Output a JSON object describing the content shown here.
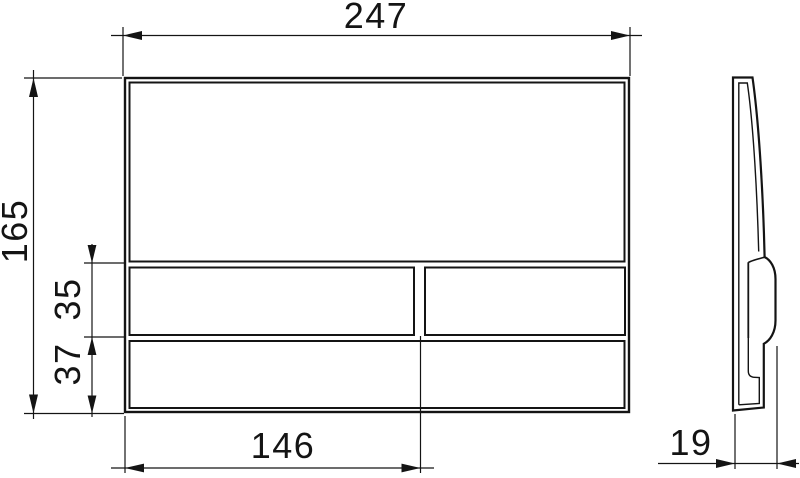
{
  "page": {
    "background_color": "#ffffff",
    "line_color": "#141414"
  },
  "drawing": {
    "front_view": {
      "overall_width": "247",
      "overall_height": "165",
      "button_row_height": "35",
      "bottom_row_height": "37",
      "large_button_width": "146"
    },
    "side_view": {
      "depth": "19"
    }
  }
}
